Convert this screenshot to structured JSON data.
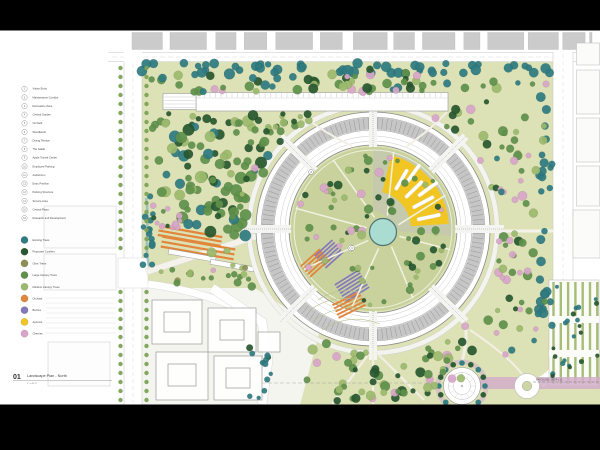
{
  "legend": {
    "numbered_items": [
      "Visitor Entry",
      "Maintenance Corridor",
      "Recreation Zone",
      "Central Garden",
      "Orchard",
      "Woodlands",
      "Dining Terrace",
      "The Glade",
      "Apple Transit Center",
      "Employee Parking",
      "Auditorium",
      "Entry Pavilion",
      "Parking Structure",
      "Service Area",
      "Central Plaza",
      "Research and Development"
    ],
    "tree_types": [
      {
        "label": "Existing Trees",
        "color": "#2e7b80"
      },
      {
        "label": "Proposed Conifers",
        "color": "#27582f"
      },
      {
        "label": "Olive Trees",
        "color": "#8d9051"
      },
      {
        "label": "Large Canopy Trees",
        "color": "#5f914b"
      },
      {
        "label": "Medium Canopy Trees",
        "color": "#9cba6d"
      },
      {
        "label": "Orchard",
        "color": "#e2863b"
      },
      {
        "label": "Berries",
        "color": "#8578bd"
      },
      {
        "label": "Apricots",
        "color": "#f1c522"
      },
      {
        "label": "Cherries",
        "color": "#d9a6c9"
      }
    ]
  },
  "title_block": {
    "number": "01",
    "title": "Landscape Plan - North",
    "scale": "1\" = 40'-0\""
  },
  "annotations": {
    "matchline": "MATCHLINE, SEE P-1.11"
  },
  "callouts": [
    {
      "n": "4",
      "x": 311,
      "y": 172
    },
    {
      "n": "6",
      "x": 352,
      "y": 248
    }
  ],
  "palette": {
    "teal": "#2e7b80",
    "dark": "#27582f",
    "green": "#5f914b",
    "med": "#9cba6d",
    "olive": "#8d9051",
    "orange": "#e2863b",
    "purple": "#8578bd",
    "yellow": "#f1c522",
    "pink": "#d9a6c9",
    "pond_fill": "#abdcd2",
    "pond_rim": "#4e746f",
    "site_green": "#dce1b6",
    "courtyard_green": "#c9d29c",
    "courtyard_gray": "#c3c9ad",
    "violet_band": "#d2aec9",
    "letterbox": "#000000"
  }
}
